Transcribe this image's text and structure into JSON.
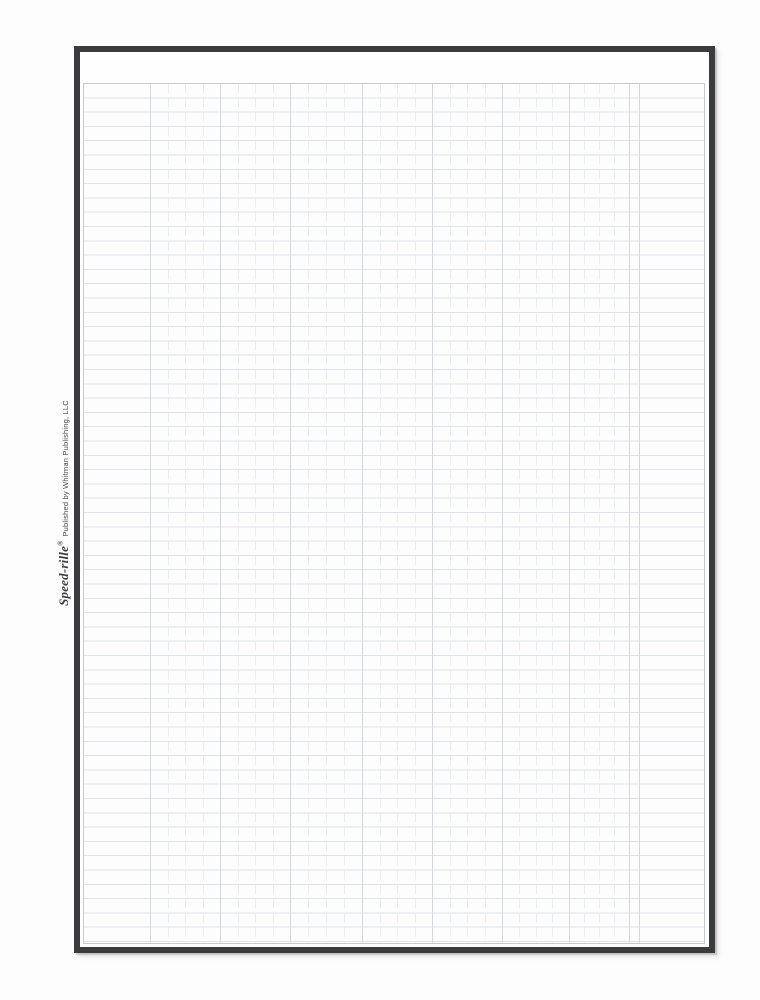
{
  "sheet": {
    "brand": "Speed-rille",
    "registered_mark": "®",
    "publisher": "Published by Whitman Publishing, LLC"
  },
  "colors": {
    "frame": "#3b3a3c",
    "grid_border": "#c6c9ce",
    "row_line": "#e0e3e7",
    "strong_column_line": "#d6d8dc",
    "faint_column_line": "#ebedf0",
    "paper": "#fdfdfe",
    "text": "#3f3f41"
  }
}
